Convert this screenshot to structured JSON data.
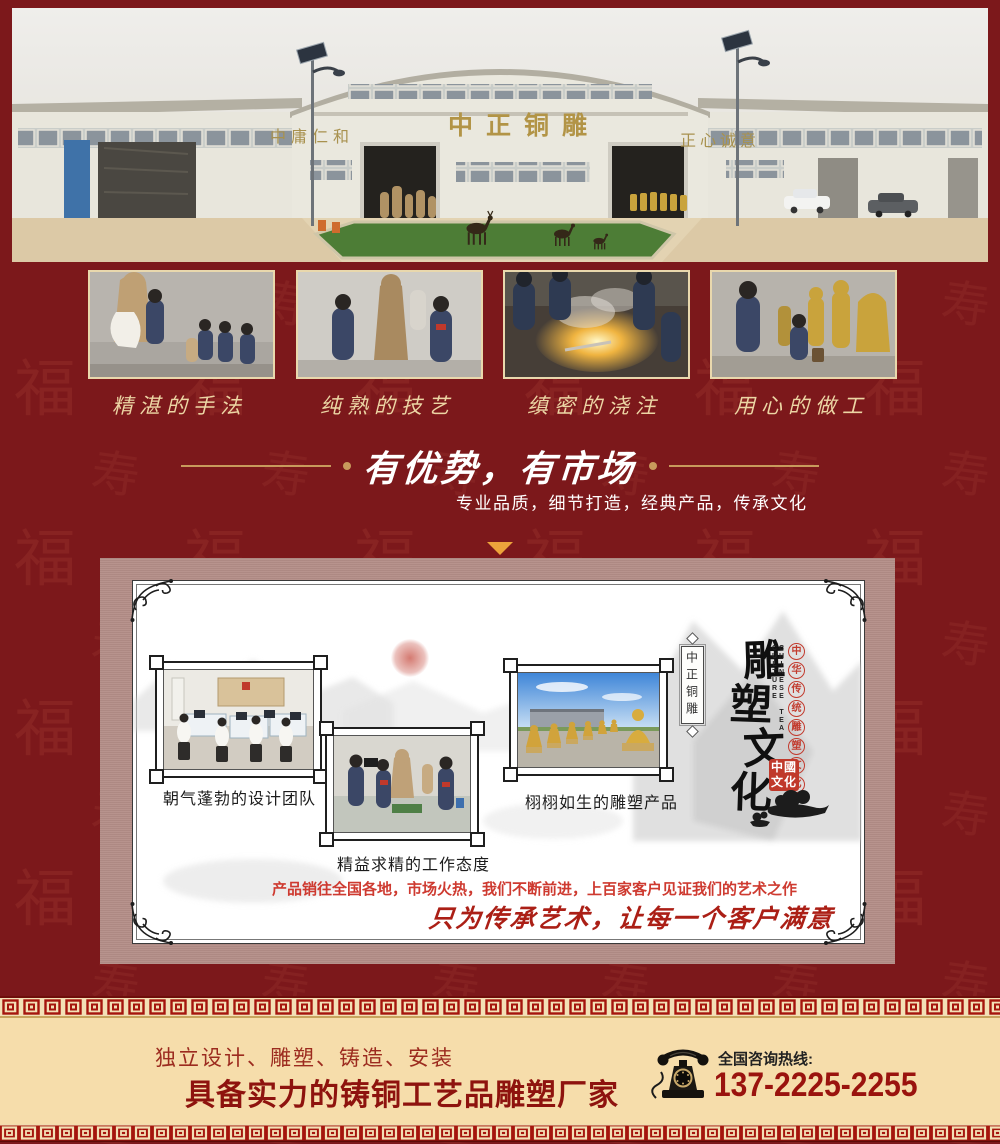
{
  "panorama": {
    "sign_left": "中庸仁和",
    "sign_center": "中正铜雕",
    "sign_right": "正心诚意"
  },
  "process": {
    "items": [
      {
        "caption": "精湛的手法"
      },
      {
        "caption": "纯熟的技艺"
      },
      {
        "caption": "缜密的浇注"
      },
      {
        "caption": "用心的做工"
      }
    ]
  },
  "advantage": {
    "title": "有优势，有市场",
    "subtitle": "专业品质，细节打造，经典产品，传承文化"
  },
  "culture": {
    "gallery": [
      {
        "caption": "朝气蓬勃的设计团队"
      },
      {
        "caption": "精益求精的工作态度"
      },
      {
        "caption": "栩栩如生的雕塑产品"
      }
    ],
    "side_scroll_text": "中正铜雕",
    "brand_chars": [
      "雕",
      "塑",
      "文",
      "化"
    ],
    "sub_chars": [
      "中",
      "华",
      "传",
      "统",
      "雕",
      "塑",
      "文",
      "化"
    ],
    "english": "CHINESE TEA CULTURE",
    "seal_text": "中國文化",
    "marketing": "产品销往全国各地，市场火热，我们不断前进，上百家客户见证我们的艺术之作",
    "slogan": "只为传承艺术，让每一个客户满意"
  },
  "footer": {
    "services": "独立设计、雕塑、铸造、安装",
    "headline": "具备实力的铸铜工艺品雕塑厂家",
    "hotline_label": "全国咨询热线:",
    "phone": "137-2225-2255"
  },
  "icons": {
    "hotline": "vintage-telephone-icon",
    "section_marker": "down-triangle-icon",
    "border_pattern": "hui-meander-border",
    "corner": "corner-flourish-icon",
    "cloud": "auspicious-cloud-icon"
  },
  "colors": {
    "page_bg": "#7c181b",
    "panel_bg": "#b38d87",
    "card_bg": "#ffffff",
    "gold_line": "#c89a5c",
    "caption_cream": "#ecd5a4",
    "footer_bg": "#f6ddab",
    "accent_red": "#9a130e",
    "bright_red": "#ce3a30",
    "triangle_gold": "#eda33b",
    "meander_red": "#a5150d",
    "meander_cream": "#f3e0b6",
    "building_gold": "#b29446"
  }
}
